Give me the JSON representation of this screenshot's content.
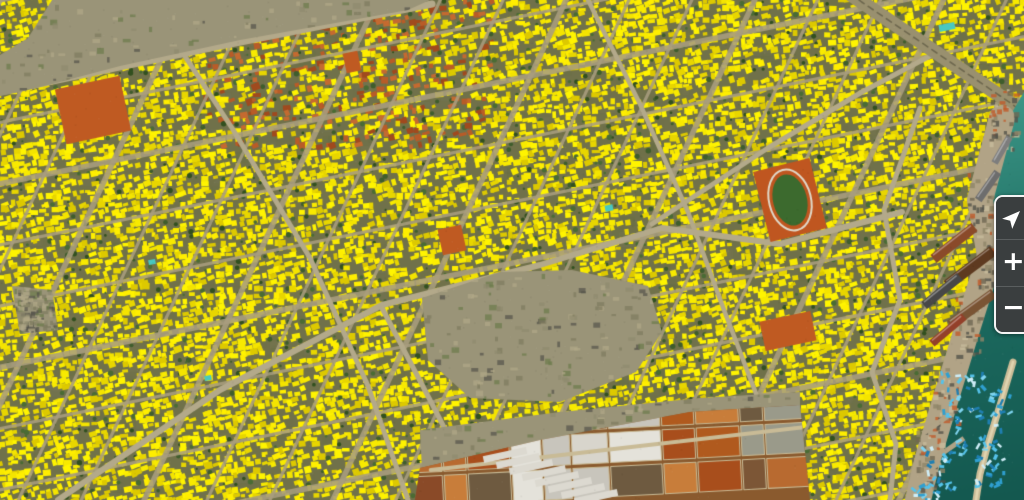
{
  "controls": {
    "zoom_in_label": "+",
    "zoom_out_label": "−",
    "locate_icon": "navigation-arrow",
    "panel_background": "#3a3e3f",
    "panel_border": "#f4f4f4",
    "icon_color": "#ffffff"
  },
  "map": {
    "width": 1024,
    "height": 500,
    "palette": {
      "ground": "#70714a",
      "mottle": [
        "#5a6b38",
        "#8c8563",
        "#7d7f6a",
        "#676b42"
      ],
      "yellows": [
        "#f4e400",
        "#ffee00",
        "#e8d600",
        "#fff400",
        "#ddc900",
        "#f8ea00"
      ],
      "reds": [
        "#b85c28",
        "#a04a1e",
        "#c46a30"
      ],
      "trees": [
        "#3f5d2c",
        "#32501f",
        "#4a6b34"
      ],
      "street": "#a89d7e",
      "artery": "#b3a98a",
      "railway": "#99906f",
      "railway_center": "#6e684f",
      "scrub_speckle": [
        "#7d7a5e",
        "#b0a888",
        "#6b7a4a",
        "#8f8a6e",
        "#54524a"
      ],
      "field_orange": "#bf5a22",
      "water_deep": "#14584f",
      "water_mid": "#1c6a5f",
      "water_light": "#3f9a8a",
      "shallow": "#55b4a4",
      "quay": "#b1a386",
      "quay_speckle": [
        "#8f8468",
        "#c8bb9c",
        "#6f6752",
        "#54524a",
        "#c05a2a"
      ],
      "breakwater": "#cdbd98",
      "breakwater_core": "#e0d4b0",
      "boat_colors": [
        "#2f9fd0",
        "#55c2ea",
        "#1f7fb2",
        "#7fd4f0",
        "#cfeef8"
      ],
      "salt_base": "#8a5a2e",
      "salt_colors": [
        "#a84e1c",
        "#c06a2c",
        "#8a4a28",
        "#b05a1e",
        "#7c5636",
        "#c87d3a",
        "#9a9a8a",
        "#6e5a40",
        "#b86a30"
      ],
      "salt_light": [
        "#d8d5cc",
        "#c8c5bc",
        "#e4e2da"
      ],
      "salt_divider": "#c9bb96",
      "warehouse": "#dcd9d0",
      "pool": "#49c8c0"
    },
    "building_grid": {
      "step": 6.5,
      "angle_deg": -11,
      "density": 0.77,
      "tree_prob": 0.09
    },
    "medina": {
      "x1": 205,
      "y1": 0,
      "x2": 492,
      "y2": 148,
      "red_prob": 0.3
    },
    "streets": {
      "family_a": {
        "angle_deg": -11.5,
        "spacing": 60
      },
      "family_b": {
        "angle_deg": -65,
        "spacing": 57
      }
    },
    "arteries": [
      {
        "pts": [
          [
            0,
            92
          ],
          [
            210,
            48
          ],
          [
            432,
            4
          ]
        ],
        "w": 7
      },
      {
        "pts": [
          [
            58,
            500
          ],
          [
            220,
            390
          ],
          [
            382,
            305
          ],
          [
            540,
            265
          ],
          [
            662,
            228
          ],
          [
            780,
            244
          ],
          [
            902,
            212
          ]
        ],
        "w": 6
      },
      {
        "pts": [
          [
            148,
            0
          ],
          [
            232,
            128
          ],
          [
            310,
            258
          ],
          [
            368,
            386
          ],
          [
            408,
            500
          ]
        ],
        "w": 5
      },
      {
        "pts": [
          [
            652,
            224
          ],
          [
            768,
            148
          ],
          [
            862,
            92
          ],
          [
            930,
            56
          ]
        ],
        "w": 5
      },
      {
        "pts": [
          [
            920,
            108
          ],
          [
            884,
            210
          ],
          [
            900,
            300
          ],
          [
            872,
            372
          ],
          [
            896,
            444
          ],
          [
            890,
            500
          ]
        ],
        "w": 5
      },
      {
        "pts": [
          [
            382,
            308
          ],
          [
            430,
            400
          ],
          [
            470,
            478
          ],
          [
            490,
            500
          ]
        ],
        "w": 5
      },
      {
        "pts": [
          [
            588,
            0
          ],
          [
            640,
            104
          ],
          [
            688,
            212
          ],
          [
            724,
            310
          ],
          [
            760,
            404
          ],
          [
            778,
            500
          ]
        ],
        "w": 4.5
      }
    ],
    "railway": {
      "pts": [
        [
          850,
          -6
        ],
        [
          1012,
          104
        ],
        [
          1024,
          114
        ]
      ],
      "w": 14
    },
    "scrub_patches": [
      {
        "pts": [
          [
            52,
            0
          ],
          [
            430,
            0
          ],
          [
            408,
            10
          ],
          [
            240,
            40
          ],
          [
            120,
            66
          ],
          [
            52,
            84
          ],
          [
            20,
            92
          ],
          [
            0,
            96
          ],
          [
            0,
            55
          ],
          [
            28,
            38
          ]
        ]
      },
      {
        "pts": [
          [
            422,
            298
          ],
          [
            500,
            272
          ],
          [
            572,
            270
          ],
          [
            648,
            286
          ],
          [
            662,
            332
          ],
          [
            636,
            372
          ],
          [
            560,
            402
          ],
          [
            470,
            398
          ],
          [
            428,
            360
          ]
        ]
      },
      {
        "pts": [
          [
            420,
            430
          ],
          [
            560,
            412
          ],
          [
            700,
            398
          ],
          [
            800,
            392
          ],
          [
            800,
            408
          ],
          [
            690,
            415
          ],
          [
            540,
            443
          ],
          [
            422,
            470
          ]
        ]
      },
      {
        "pts": [
          [
            12,
            286
          ],
          [
            52,
            290
          ],
          [
            58,
            330
          ],
          [
            20,
            334
          ]
        ]
      }
    ],
    "scrub_color": "#9a9478",
    "salt_pans": {
      "clip": [
        [
          420,
          468
        ],
        [
          540,
          440
        ],
        [
          690,
          412
        ],
        [
          800,
          405
        ],
        [
          810,
          500
        ],
        [
          415,
          500
        ]
      ],
      "col_w_min": 22,
      "col_w_max": 56,
      "row_ys": [
        396,
        430,
        464
      ],
      "row_h": 32,
      "light_x1": 492,
      "light_x2": 652
    },
    "warehouses": {
      "x": 505,
      "y": 455,
      "n": 8,
      "w": 44,
      "h": 7,
      "dx": 13,
      "dy": 6,
      "rot": -12
    },
    "fields": [
      {
        "x": 93,
        "y": 110,
        "w": 66,
        "h": 56,
        "rot": -12
      },
      {
        "x": 452,
        "y": 240,
        "w": 24,
        "h": 26,
        "rot": -12
      },
      {
        "x": 352,
        "y": 62,
        "w": 15,
        "h": 20,
        "rot": -12
      },
      {
        "x": 788,
        "y": 331,
        "w": 52,
        "h": 30,
        "rot": -12
      }
    ],
    "stadium": {
      "x": 790,
      "y": 200,
      "w": 58,
      "h": 72,
      "rot": -14,
      "ring": "#bf5620",
      "grass": "#3c6a2e",
      "track": "#e0d8c8"
    },
    "pools": [
      {
        "x": 947,
        "y": 27,
        "w": 16,
        "h": 7,
        "rot": -12
      },
      {
        "x": 609,
        "y": 208,
        "w": 8,
        "h": 6,
        "rot": -11
      },
      {
        "x": 152,
        "y": 262,
        "w": 7,
        "h": 5,
        "rot": -11
      },
      {
        "x": 208,
        "y": 378,
        "w": 7,
        "h": 5,
        "rot": -11
      }
    ],
    "water": {
      "poly": [
        [
          1024,
          92
        ],
        [
          1004,
          126
        ],
        [
          982,
          198
        ],
        [
          992,
          252
        ],
        [
          970,
          328
        ],
        [
          948,
          396
        ],
        [
          930,
          456
        ],
        [
          920,
          500
        ],
        [
          1024,
          500
        ]
      ],
      "coast": [
        [
          1004,
          126
        ],
        [
          982,
          198
        ],
        [
          992,
          252
        ],
        [
          970,
          328
        ],
        [
          948,
          396
        ],
        [
          930,
          456
        ],
        [
          920,
          500
        ]
      ]
    },
    "quay": {
      "pts": [
        [
          1002,
          118
        ],
        [
          980,
          200
        ],
        [
          990,
          256
        ],
        [
          968,
          326
        ],
        [
          946,
          398
        ],
        [
          928,
          458
        ],
        [
          918,
          500
        ]
      ],
      "w": 26
    },
    "piers": [
      {
        "x": 935,
        "y": 425,
        "w": 30,
        "h": 5,
        "rot": -35
      },
      {
        "x": 950,
        "y": 448,
        "w": 34,
        "h": 5,
        "rot": -35
      },
      {
        "x": 930,
        "y": 470,
        "w": 26,
        "h": 4,
        "rot": -35
      }
    ],
    "ships": [
      {
        "x": 954,
        "y": 243,
        "w": 52,
        "h": 10,
        "rot": -38,
        "color": "#8a4a2a"
      },
      {
        "x": 970,
        "y": 268,
        "w": 58,
        "h": 11,
        "rot": -37,
        "color": "#5e3a20"
      },
      {
        "x": 942,
        "y": 291,
        "w": 46,
        "h": 9,
        "rot": -39,
        "color": "#474747"
      },
      {
        "x": 972,
        "y": 309,
        "w": 54,
        "h": 10,
        "rot": -36,
        "color": "#7a5434"
      },
      {
        "x": 948,
        "y": 330,
        "w": 42,
        "h": 8,
        "rot": -40,
        "color": "#93402a"
      },
      {
        "x": 988,
        "y": 186,
        "w": 34,
        "h": 8,
        "rot": -55,
        "color": "#6d6d6d"
      },
      {
        "x": 1002,
        "y": 150,
        "w": 30,
        "h": 7,
        "rot": -60,
        "color": "#7d7d7d"
      }
    ],
    "breakwater": {
      "pts": [
        [
          1013,
          362
        ],
        [
          1001,
          402
        ],
        [
          988,
          444
        ],
        [
          980,
          474
        ],
        [
          976,
          500
        ]
      ]
    },
    "boat_clusters": [
      {
        "cx": 962,
        "cy": 395,
        "n": 26,
        "r": 22
      },
      {
        "cx": 978,
        "cy": 432,
        "n": 30,
        "r": 24
      },
      {
        "cx": 945,
        "cy": 468,
        "n": 26,
        "r": 22
      },
      {
        "cx": 988,
        "cy": 472,
        "n": 20,
        "r": 16
      },
      {
        "cx": 925,
        "cy": 492,
        "n": 14,
        "r": 14
      },
      {
        "cx": 999,
        "cy": 402,
        "n": 12,
        "r": 12
      }
    ]
  }
}
